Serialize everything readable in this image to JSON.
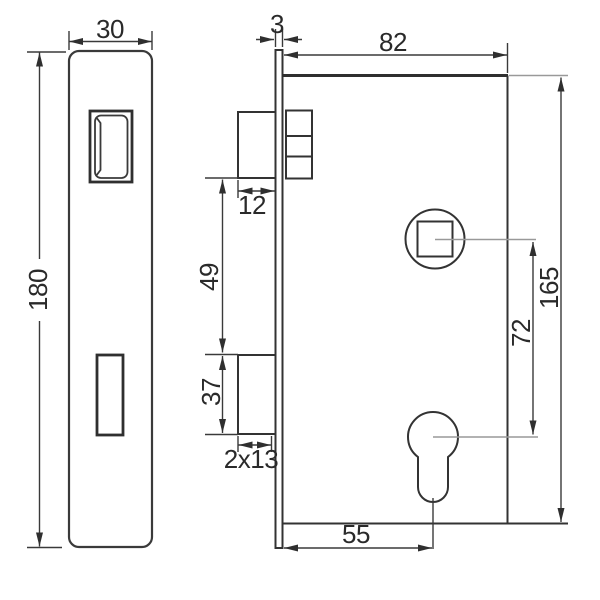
{
  "title": "Mortise lock technical dimension drawing",
  "dimensions": {
    "faceplate_width": "30",
    "faceplate_thickness": "3",
    "case_depth": "82",
    "faceplate_height": "180",
    "latch_width": "12",
    "latch_to_bolt_gap": "49",
    "bolt_height": "37",
    "bolt_throw": "2x13",
    "follower_to_cylinder": "72",
    "case_height": "165",
    "backset": "55"
  }
}
